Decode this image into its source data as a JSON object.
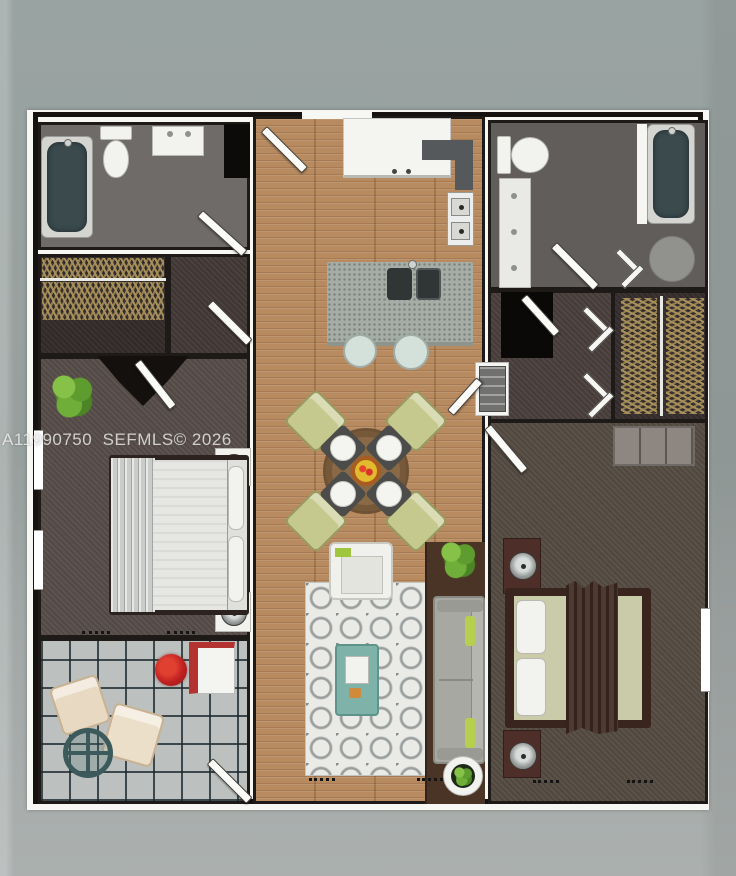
{
  "watermark": {
    "text": "A11990750  SEFMLS© 2026"
  },
  "floor_plan": {
    "type": "top-down 3D rendered apartment floor plan, 2 bedrooms / 2 bathrooms",
    "rooms": [
      "bathroom-left",
      "closet-left",
      "entry-hall-left",
      "bedroom-left",
      "balcony-patio",
      "kitchen-dining-living (wood strip)",
      "bathroom-right",
      "interior-hall-right",
      "closet-right",
      "bedroom-right"
    ],
    "furniture": [
      "bathtub-left",
      "toilet-left",
      "vanity-left",
      "hanger-rods",
      "bed-left-with-canopy-drape",
      "nightstands-with-lamps",
      "potted-plants",
      "patio-chairs",
      "patio-round-table",
      "red-flower-pot",
      "patio-cabinet",
      "kitchen-counter",
      "corner-counter",
      "stove",
      "island-with-double-sink",
      "two-bar-stools",
      "round-dining-table",
      "four-green-chairs",
      "four-place-settings",
      "fruit-bowl",
      "area-rug",
      "armchair",
      "teal-coffee-table",
      "gray-sofa-with-green-pillows",
      "round-planter",
      "washer",
      "black-pantry-closet",
      "toilet-right",
      "vanity-right",
      "bathtub-right",
      "round-shower-seat",
      "dresser",
      "bed-right-green-bedding-brown-throw"
    ]
  },
  "colors": {
    "background": "#99a3a1",
    "sheet": "#f7f7f4",
    "wall": "#16120f",
    "wood_floor": "#b78a5f",
    "carpet_left": "#584e4a",
    "carpet_right": "#564c44",
    "bath_floor": "#6e6b69",
    "tile_floor": "#bcc0be",
    "tub": "#3a4a4d",
    "island_granite": "#a6aca6",
    "sofa": "#a8a8a2",
    "accent_green_pillow": "#b7cf4e",
    "dining_chair": "#c6c98e",
    "table_wood": "#8a6a46",
    "rug": "#eaebe7",
    "teal_table": "#3c5a5c",
    "red_flower": "#c22222",
    "hanger_tan": "#a8905c",
    "throw_brown": "#452f26"
  }
}
